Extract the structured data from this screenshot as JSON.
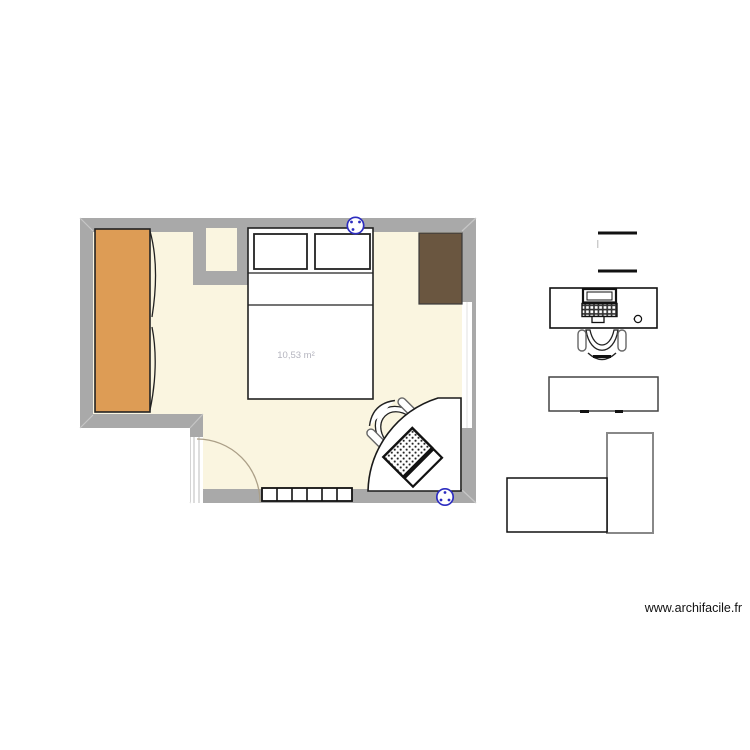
{
  "watermark": {
    "text": "www.archifacile.fr"
  },
  "plan": {
    "room": {
      "area_label": "10,53 m²",
      "area_label_color": "#b4b4be"
    },
    "colors": {
      "wall": "#a9a9a9",
      "wall_bevel": "#c6c6c6",
      "floor": "#faf5e0",
      "wardrobe": "#dd9c55",
      "shelf": "#6a5640",
      "outline_dark": "#1a1a1a",
      "outlet_blue": "#2d2dc0",
      "door_arc": "#ab9f87",
      "furniture_gray": "#888888"
    },
    "symbols": [
      "wardrobe",
      "closet-nook",
      "double-bed",
      "wall-shelf",
      "corner-desk",
      "desk-chair",
      "laptop",
      "radiator",
      "door",
      "window",
      "power-outlet"
    ],
    "annex_symbols": [
      "window-symbol",
      "desk-with-laptop",
      "office-chair",
      "side-table",
      "l-shaped-desk"
    ]
  }
}
